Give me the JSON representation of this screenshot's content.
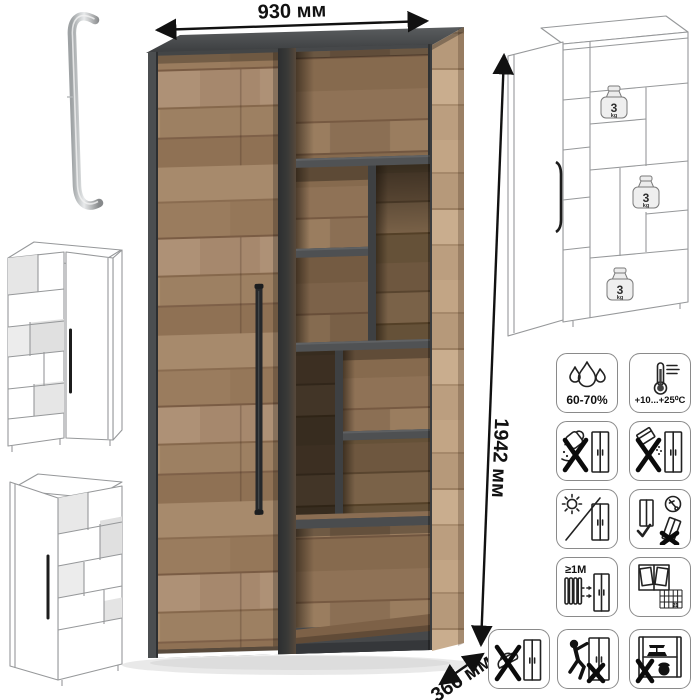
{
  "page": {
    "background": "#ffffff"
  },
  "dimensions": {
    "width": "930 мм",
    "height": "1942 мм",
    "depth": "366 мм"
  },
  "shelf_load": {
    "value": "3",
    "unit": "kg"
  },
  "care_labels": {
    "humidity": "60-70%",
    "temperature": "+10...+25⁰С",
    "heater_distance": "≥1М",
    "ventilation_days": "21"
  },
  "care_icons": [
    "humidity-icon",
    "temperature-icon",
    "no-liquids-icon",
    "no-powder-icon",
    "no-direct-sunlight-icon",
    "transport-upright-icon",
    "heater-distance-icon",
    "ventilation-icon",
    "no-iron-icon",
    "no-climbing-icon",
    "no-overload-icon"
  ],
  "colors": {
    "wood": "#a78a6c",
    "wood_dark": "#7d614a",
    "frame_dark": "#46484a",
    "handle": "#26282b",
    "dimension_text": "#111111",
    "wireframe_line": "#96989a"
  }
}
